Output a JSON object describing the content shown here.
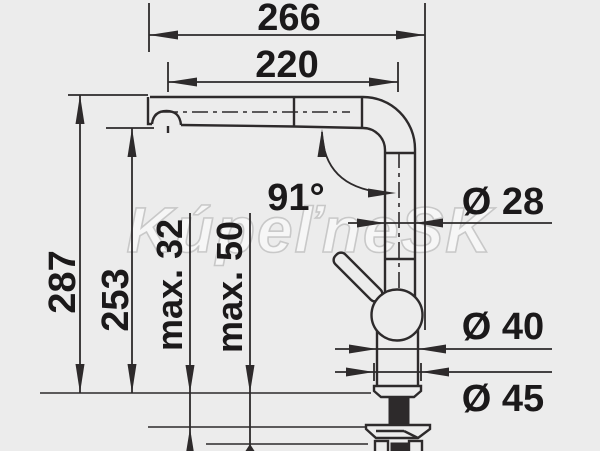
{
  "drawing": {
    "type": "technical-dimension-drawing",
    "subject": "kitchen faucet with pull-out spray, side view",
    "watermark": "KúpeľneSK",
    "colors": {
      "background": "#ececec",
      "line": "#2d2a2b",
      "text": "#1b191a",
      "watermark_fill": "#f7f7f7",
      "watermark_outline": "#adadad"
    },
    "dimensions": {
      "overall_reach": "266",
      "spout_reach": "220",
      "overall_height": "287",
      "spout_outlet_height": "253",
      "max_counter_thickness_1": "max. 32",
      "max_counter_thickness_2": "max. 50",
      "spout_angle": "91°",
      "pipe_diameter": "Ø 28",
      "body_diameter": "Ø 40",
      "base_diameter": "Ø 45"
    }
  }
}
